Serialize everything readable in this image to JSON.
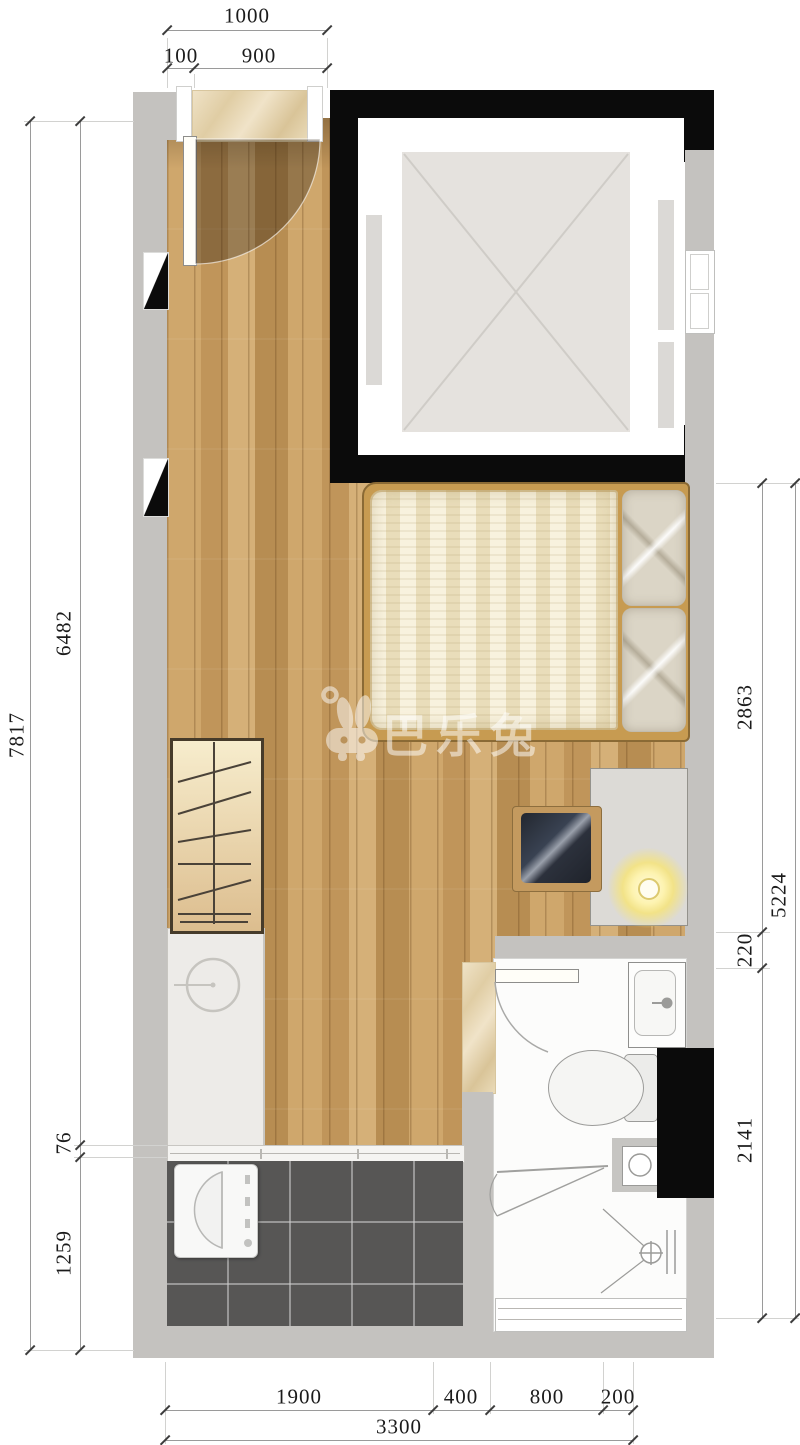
{
  "title": "studio-apartment-floor-plan",
  "watermark": {
    "text": "巴乐兔",
    "icon": "rabbit-logo-icon"
  },
  "dims": {
    "top": {
      "total": "1000",
      "seg_a": "100",
      "seg_b": "900"
    },
    "left": {
      "total": "7817",
      "seg_a": "6482",
      "seg_b": "76",
      "seg_c": "1259"
    },
    "right": {
      "total": "5224",
      "seg_a": "2863",
      "seg_b": "220",
      "seg_c": "2141"
    },
    "bottom": {
      "total": "3300",
      "seg_a": "1900",
      "seg_b": "400",
      "seg_c": "800",
      "seg_d": "200"
    }
  },
  "rooms": {
    "main_room": "living-sleeping-area",
    "shaft": "elevator-shaft",
    "bathroom": "bathroom",
    "balcony": "balcony",
    "entry": "entry-door"
  },
  "furniture": [
    "entry-door",
    "bed",
    "pillows",
    "wardrobe",
    "armchair",
    "side-table",
    "lamp",
    "kitchen-counter",
    "sink",
    "sliding-door-track",
    "washing-machine",
    "washbasin",
    "toilet",
    "shower",
    "floor-drain",
    "window"
  ],
  "colors": {
    "wall": "#c4c2bf",
    "structure_black": "#0b0b0b",
    "wood_floor": "#c89f63",
    "balcony_tile": "#575655",
    "bed_frame": "#c79b51",
    "watermark": "rgba(255,255,255,0.52)"
  }
}
